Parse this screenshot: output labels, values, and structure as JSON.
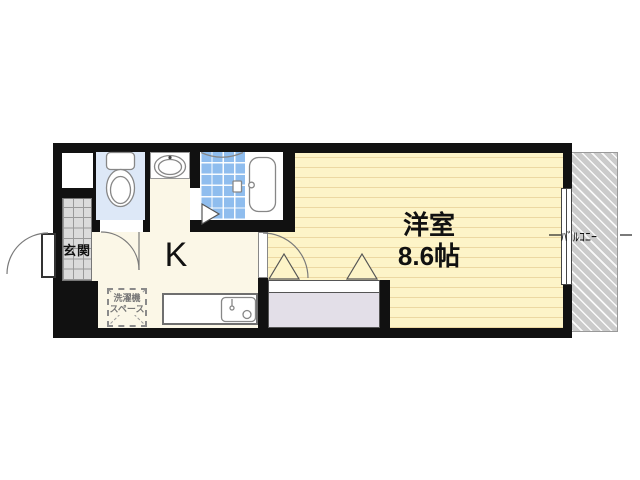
{
  "labels": {
    "entrance": "玄関",
    "kitchen": "K",
    "main_room_name": "洋室",
    "main_room_size": "8.6帖",
    "washer_space_line1": "洗濯機",
    "washer_space_line2": "スペース",
    "balcony": "ﾊﾞﾙｺﾆｰ"
  },
  "colors": {
    "wall": "#111111",
    "hall_floor": "#fbf7e7",
    "western_room_floor": "#fdf4c8",
    "western_room_stripe": "#ecd8a2",
    "toilet_floor": "#dde8f7",
    "bath_tile": "#8fbdee",
    "entrance_tile": "#dbdbdb",
    "closet_fill": "#e3dfe8",
    "balcony_fill": "#cbcbcb",
    "fixture_outline": "#878787"
  },
  "rooms": [
    {
      "name": "entrance",
      "label": "玄関"
    },
    {
      "name": "kitchen",
      "label": "K"
    },
    {
      "name": "western-room",
      "label": "洋室 8.6帖"
    },
    {
      "name": "washer-space",
      "label": "洗濯機スペース"
    },
    {
      "name": "balcony",
      "label": "ﾊﾞﾙｺﾆｰ"
    }
  ]
}
